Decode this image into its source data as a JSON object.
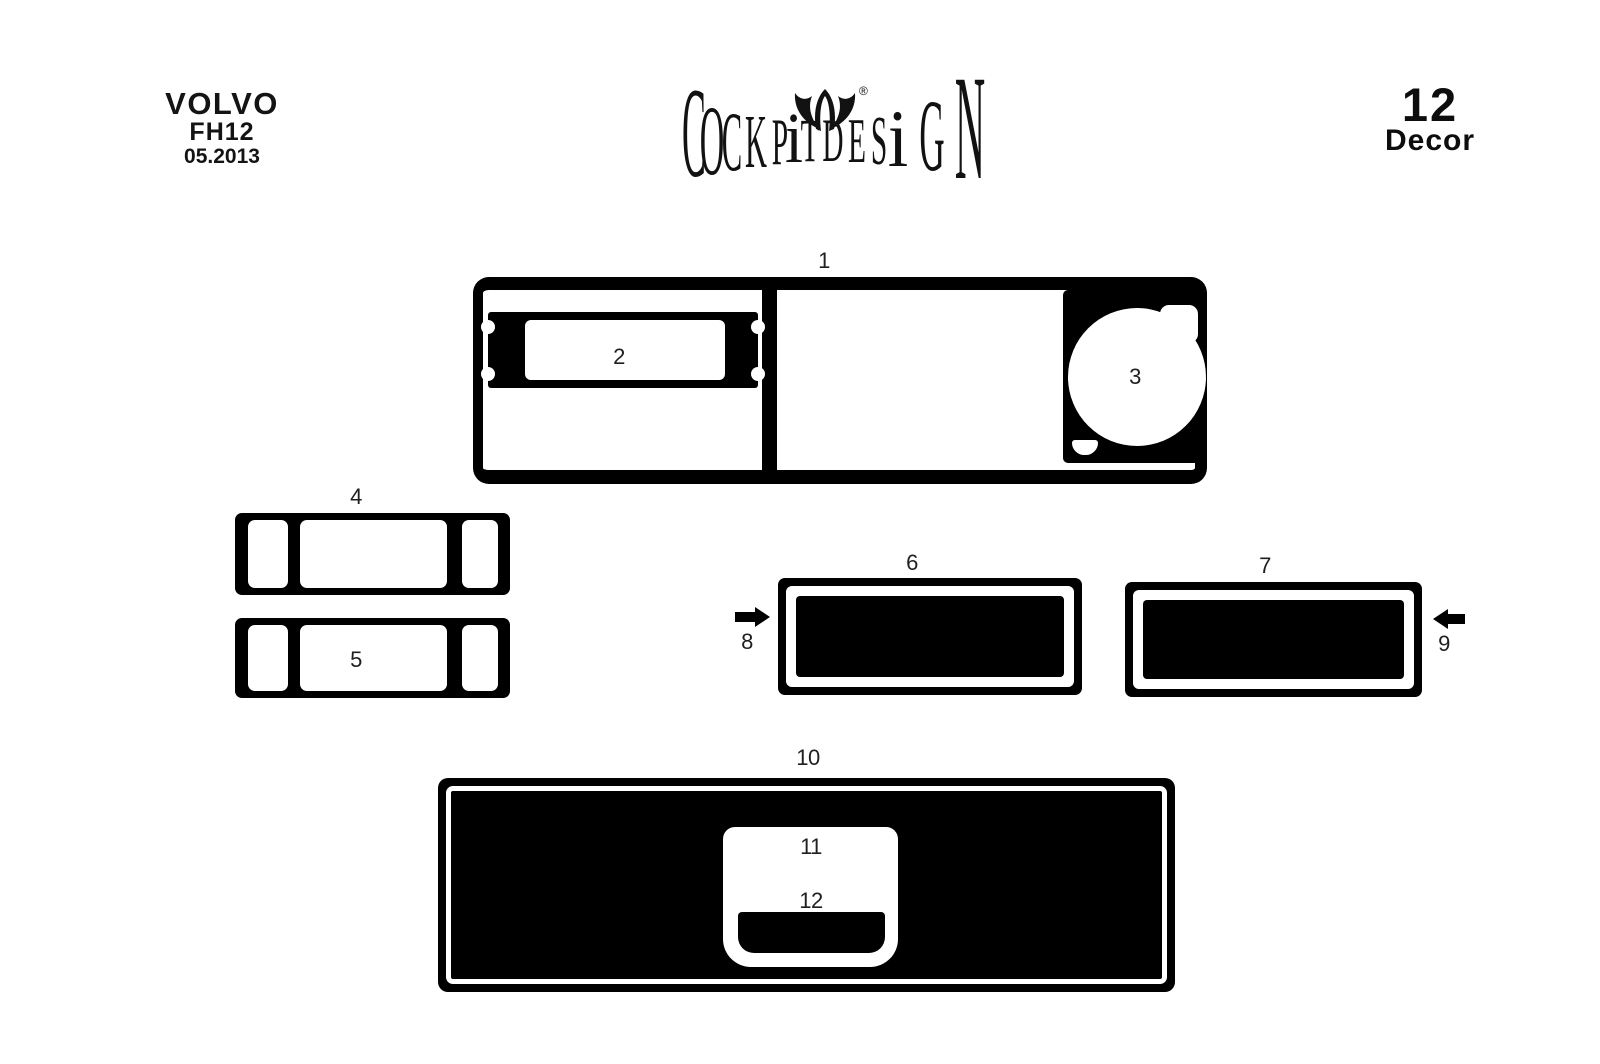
{
  "header": {
    "brand": {
      "make": "VOLVO",
      "model": "FH12",
      "date": "05.2013"
    },
    "logo": {
      "full_text": "COCKPITDESIGN",
      "letters": [
        "C",
        "O",
        "C",
        "K",
        "P",
        "i",
        "T",
        "D",
        "E",
        "S",
        "i",
        "G",
        "N"
      ],
      "registered_mark": "®",
      "crest_icon": "winged-crest"
    },
    "decor_count": {
      "value": "12",
      "label": "Decor"
    }
  },
  "diagram": {
    "piece_labels": [
      "1",
      "2",
      "3",
      "4",
      "5",
      "6",
      "7",
      "8",
      "9",
      "10",
      "11",
      "12"
    ],
    "arrows": [
      {
        "label": "8",
        "direction": "right"
      },
      {
        "label": "9",
        "direction": "left"
      }
    ]
  },
  "colors": {
    "shape_fill": "#000000",
    "background": "#ffffff",
    "label_text": "#1f1f1f"
  }
}
